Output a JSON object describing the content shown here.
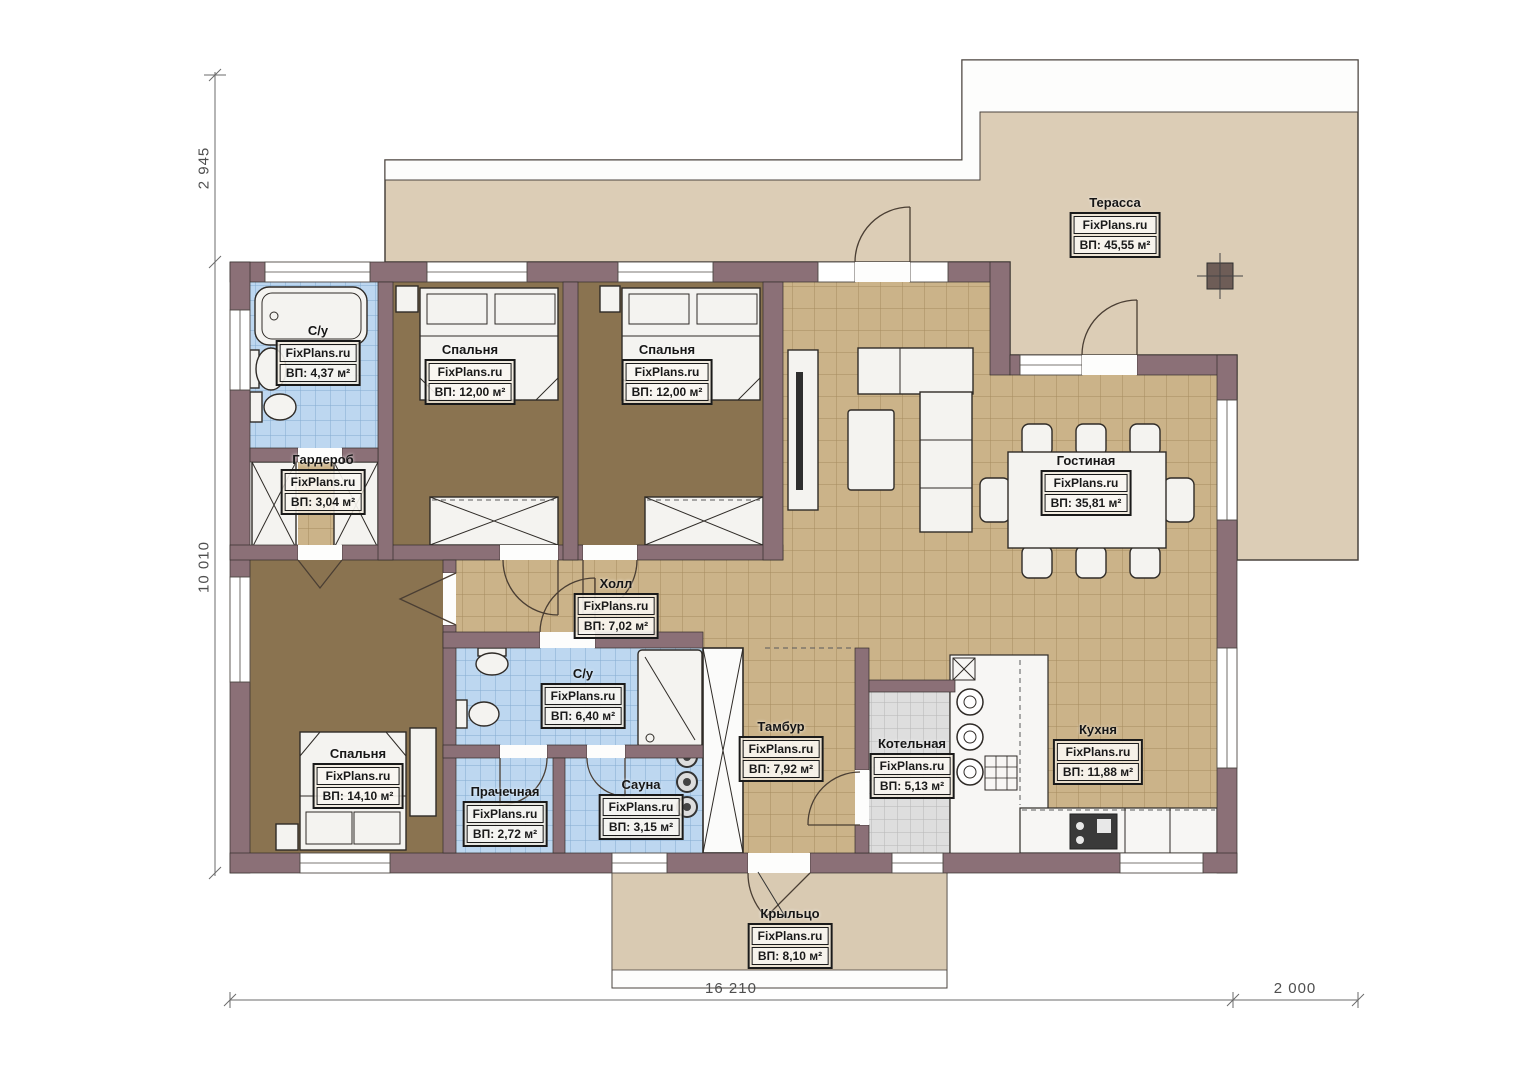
{
  "site": "FixPlans.ru",
  "rooms": [
    {
      "name": "Терасса",
      "area": "ВП: 45,55 м²"
    },
    {
      "name": "С/у",
      "area": "ВП: 4,37 м²"
    },
    {
      "name": "Спальня",
      "area": "ВП: 12,00 м²"
    },
    {
      "name": "Спальня",
      "area": "ВП: 12,00 м²"
    },
    {
      "name": "Гардероб",
      "area": "ВП: 3,04 м²"
    },
    {
      "name": "Гостиная",
      "area": "ВП: 35,81 м²"
    },
    {
      "name": "Холл",
      "area": "ВП: 7,02 м²"
    },
    {
      "name": "С/у",
      "area": "ВП: 6,40 м²"
    },
    {
      "name": "Спальня",
      "area": "ВП: 14,10 м²"
    },
    {
      "name": "Прачечная",
      "area": "ВП: 2,72 м²"
    },
    {
      "name": "Сауна",
      "area": "ВП: 3,15 м²"
    },
    {
      "name": "Тамбур",
      "area": "ВП: 7,92 м²"
    },
    {
      "name": "Котельная",
      "area": "ВП: 5,13 м²"
    },
    {
      "name": "Кухня",
      "area": "ВП: 11,88 м²"
    },
    {
      "name": "Крыльцо",
      "area": "ВП: 8,10 м²"
    }
  ],
  "dimensions": {
    "left_top": "2 945",
    "left_main": "10 010",
    "bottom_main": "16 210",
    "bottom_right": "2 000"
  },
  "colors": {
    "wall": "#8b7077",
    "terrace": "#dccdb6",
    "tile_beige": "#cbb389",
    "tile_blue": "#bdd7f0",
    "tile_gray": "#dedede",
    "wood_floor": "#8a7350"
  }
}
